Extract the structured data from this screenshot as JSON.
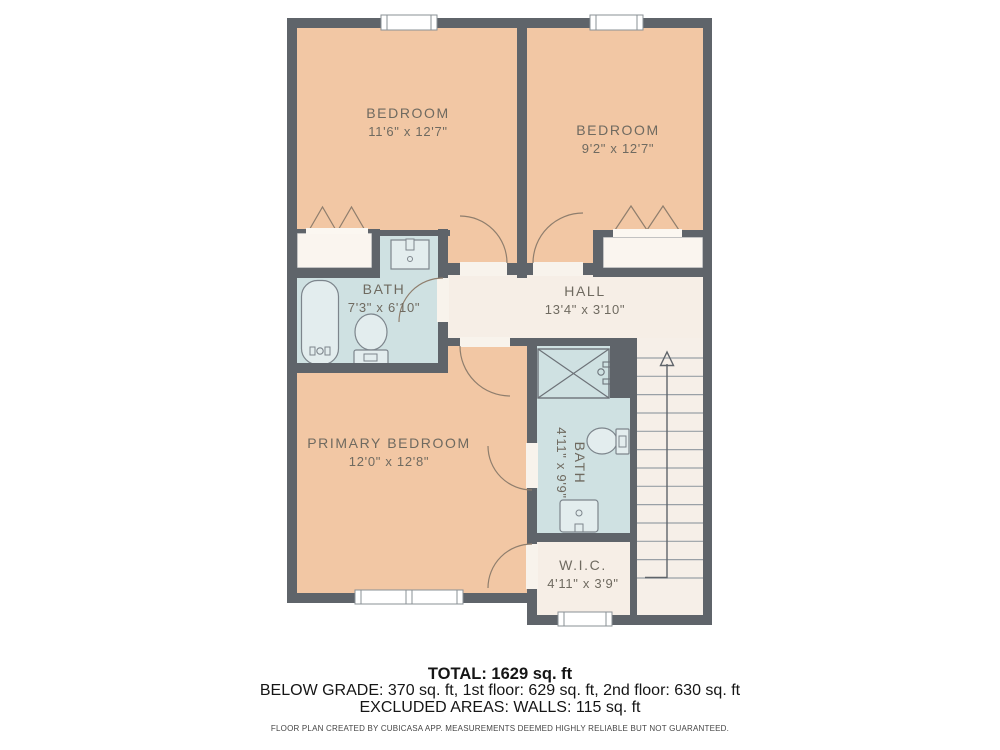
{
  "plan": {
    "rooms": [
      {
        "key": "bedroom-1",
        "name": "BEDROOM",
        "dims": "11'6\" x 12'7\""
      },
      {
        "key": "bedroom-2",
        "name": "BEDROOM",
        "dims": "9'2\" x 12'7\""
      },
      {
        "key": "bath-1",
        "name": "BATH",
        "dims": "7'3\" x 6'10\""
      },
      {
        "key": "hall",
        "name": "HALL",
        "dims": "13'4\" x 3'10\""
      },
      {
        "key": "primary-bedroom",
        "name": "PRIMARY BEDROOM",
        "dims": "12'0\" x 12'8\""
      },
      {
        "key": "bath-2",
        "name": "BATH",
        "dims": "4'11\" x 9'9\""
      },
      {
        "key": "wic",
        "name": "W.I.C.",
        "dims": "4'11\" x 3'9\""
      }
    ],
    "colors": {
      "wall": "#5f646a",
      "room_peach": "#f2c7a4",
      "room_blue": "#cfe1e2",
      "room_cream": "#f6eee6",
      "closet_white": "#faf5ef",
      "fixture_fill": "#e0eaec",
      "label_text": "#6f6a60"
    }
  },
  "summary": {
    "total": "TOTAL: 1629 sq. ft",
    "breakdown": "BELOW GRADE: 370 sq. ft, 1st floor: 629 sq. ft, 2nd floor: 630 sq. ft",
    "excluded": "EXCLUDED AREAS: WALLS: 115 sq. ft",
    "disclaimer": "FLOOR PLAN CREATED BY CUBICASA APP. MEASUREMENTS DEEMED HIGHLY RELIABLE BUT NOT GUARANTEED."
  }
}
